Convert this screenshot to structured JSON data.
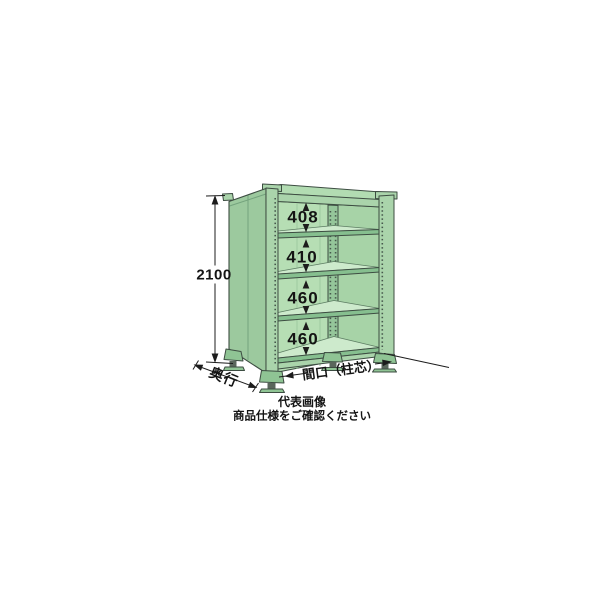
{
  "illustration": {
    "subject": "steel shelving rack, single unit, open front, four adjustable shelves with dimension callouts",
    "colors": {
      "outline": "#3d4d42",
      "side_panel": "#9cc99e",
      "front_frame": "#aad4ab",
      "top_face": "#b2dcb2",
      "interior_back": "#b6deb4",
      "interior_right": "#a7d3a7",
      "back_post": "#95c69a",
      "shelf_edge": "#86bf8f",
      "shelf_surface": "#cdeacc",
      "foot": "#8fc494",
      "hardware": "#5a665c",
      "dimension_line": "#1c1c1c"
    }
  },
  "dimensions": {
    "overall_height_mm": "2100",
    "shelf_spacings_mm": [
      "408",
      "410",
      "460",
      "460"
    ],
    "depth_label": "奥行",
    "width_label": "間口（柱芯）"
  },
  "caption": {
    "line1": "代表画像",
    "line2": "商品仕様をご確認ください"
  }
}
